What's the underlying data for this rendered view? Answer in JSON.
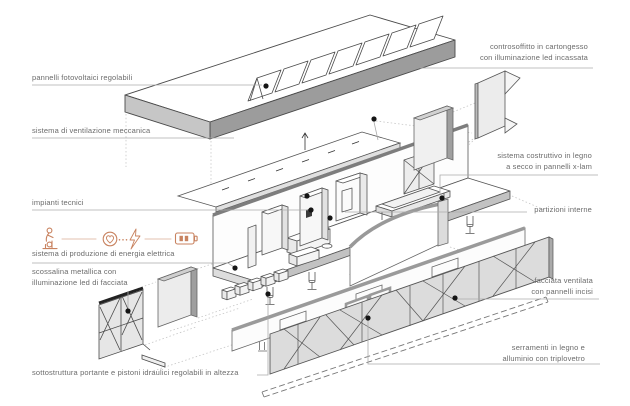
{
  "title": "Esploso assonometrico modulo abitativo",
  "colors": {
    "accent": "#c8825f",
    "leader_line": "#ababab",
    "label_text": "#6b6b6b",
    "dot": "#151515",
    "panel_fill": "#e6e6e6",
    "dark_edge": "#9c9c9c"
  },
  "labels": {
    "left": {
      "photovoltaic": "pannelli fotovoltaici regolabili",
      "ventilation": "sistema di ventilazione meccanica",
      "technical": "impianti tecnici",
      "energy": "sistema di produzione di energia elettrica",
      "flashing_line1": "scossalina metallica con",
      "flashing_line2": "illuminazione led di facciata",
      "substructure": "sottostruttura portante e pistoni idraulici regolabili in altezza"
    },
    "right": {
      "ceiling_line1": "controsoffitto in cartongesso",
      "ceiling_line2": "con illuminazione led incassata",
      "structure_line1": "sistema costruttivo in legno",
      "structure_line2": "a secco in pannelli x-lam",
      "partitions": "partizioni interne",
      "facade_line1": "facciata ventilata",
      "facade_line2": "con pannelli incisi",
      "windows_line1": "serramenti in legno e",
      "windows_line2": "alluminio con triplovetro"
    }
  },
  "energy_icons": [
    "pedal-generator-icon",
    "heart-circle-icon",
    "ellipsis-dots",
    "lightning-bolt-icon",
    "battery-icon"
  ]
}
